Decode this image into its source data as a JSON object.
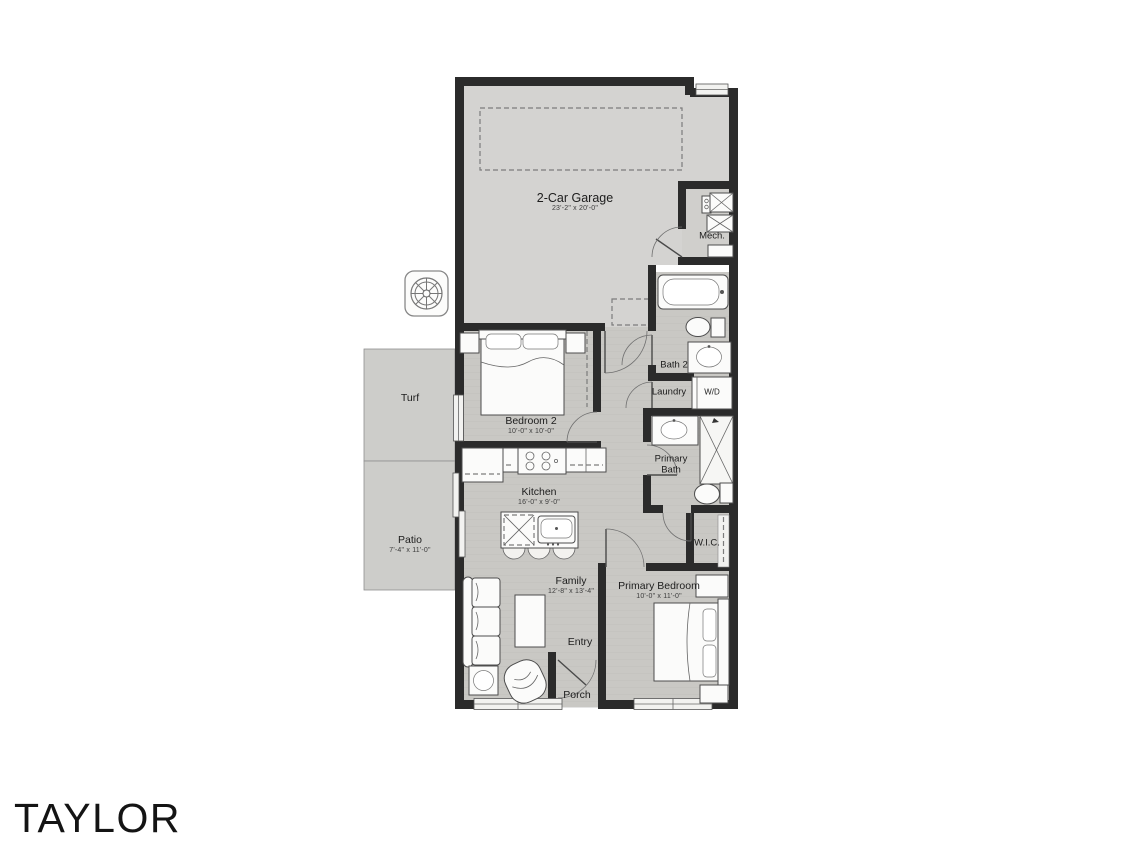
{
  "title": "TAYLOR",
  "icons": {
    "compass": "compass-rose"
  },
  "colors": {
    "wall": "#2b2b2b",
    "garage_floor": "#d4d3d1",
    "interior_floor": "#c9c8c4",
    "outdoor": "#cdcdca",
    "porch": "#d8d7d5",
    "fixture": "#fbfbfa"
  },
  "rooms": {
    "garage": {
      "label": "2-Car Garage",
      "dims": "23'-2\" x 20'-0\""
    },
    "mech": {
      "label": "Mech."
    },
    "bath2": {
      "label": "Bath 2"
    },
    "laundry": {
      "label": "Laundry"
    },
    "washer_dryer": {
      "label": "W/D"
    },
    "primary_bath": {
      "label": "Primary Bath"
    },
    "wic": {
      "label": "W.I.C."
    },
    "primary_bedroom": {
      "label": "Primary Bedroom",
      "dims": "10'-0\" x 11'-0\""
    },
    "bedroom2": {
      "label": "Bedroom 2",
      "dims": "10'-0\" x 10'-0\""
    },
    "kitchen": {
      "label": "Kitchen",
      "dims": "16'-0\" x 9'-0\""
    },
    "family": {
      "label": "Family",
      "dims": "12'-8\" x 13'-4\""
    },
    "entry": {
      "label": "Entry"
    },
    "porch": {
      "label": "Porch"
    },
    "turf": {
      "label": "Turf"
    },
    "patio": {
      "label": "Patio",
      "dims": "7'-4\" x 11'-0\""
    }
  }
}
